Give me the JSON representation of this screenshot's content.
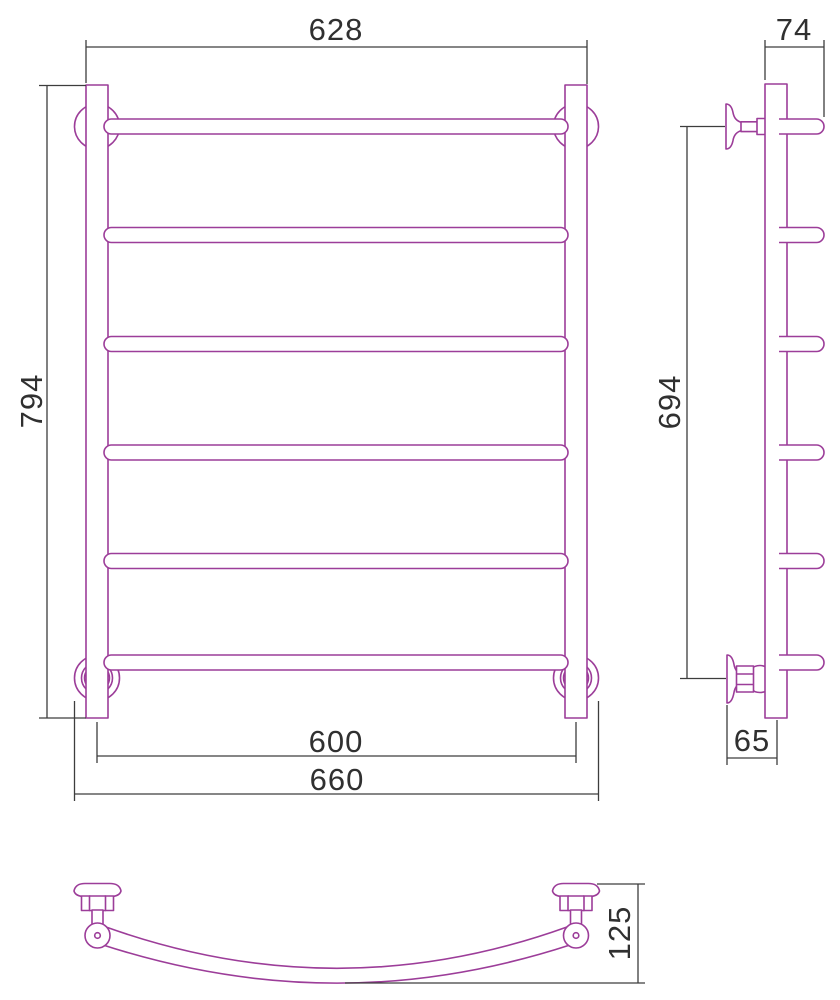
{
  "drawing": {
    "subject": "ladder-towel-rail-technical-drawing",
    "colors": {
      "part": "#9c3d99",
      "dims": "#3d3d3d",
      "text": "#303030",
      "background": "#ffffff"
    },
    "dimensions": {
      "front_overall_width": "628",
      "side_depth": "74",
      "front_overall_height": "794",
      "side_bracket_span": "694",
      "front_rail_center_span": "600",
      "front_flange_outer_span": "660",
      "side_wall_to_post": "65",
      "top_view_profile_depth": "125"
    }
  }
}
